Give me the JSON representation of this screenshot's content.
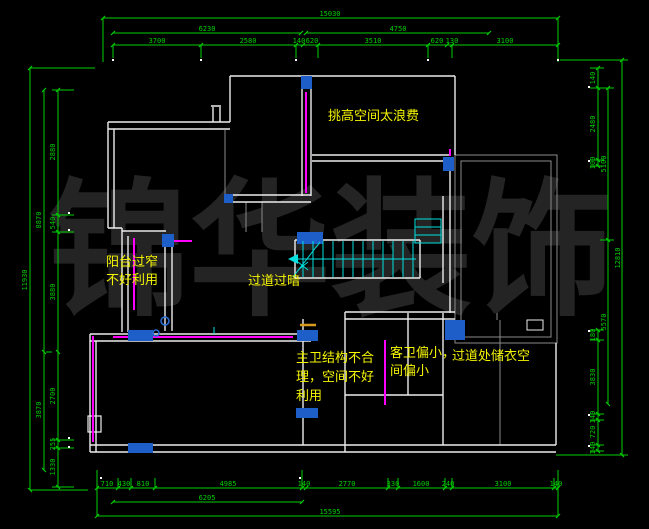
{
  "app": {
    "type": "cad-floor-plan",
    "background": "#000000"
  },
  "watermark": {
    "text": "锦华装饰",
    "color": "#242424"
  },
  "colors": {
    "dimension_green": "#00cf00",
    "wall_white": "#ededed",
    "secondary_gray": "#8a8a8a",
    "accent_magenta": "#ff00ff",
    "fill_blue": "#1d5ec9",
    "stairs_cyan": "#00e0e0",
    "annotation_yellow": "#f5f500",
    "orange": "#d99a1e"
  },
  "annotations": {
    "high_ceiling": "挑高空间太浪费",
    "balcony_line1": "阳台过窄",
    "balcony_line2": "不好利用",
    "corridor_dark": "过道过暗",
    "master_bath_line1": "主卫结构不合",
    "master_bath_line2": "理，空间不好",
    "master_bath_line3": "利用",
    "guest_bath_line1": "客卫偏小，",
    "guest_bath_line2": "间偏小",
    "closet_note": "过道处储衣空"
  },
  "dimensions": {
    "top": {
      "total": "15030",
      "row2": [
        "6230",
        "4750"
      ],
      "row3": [
        "3700",
        "2580",
        "140",
        "620",
        "3510",
        "620",
        "130",
        "3100"
      ]
    },
    "bottom": {
      "row1": [
        "710",
        "430",
        "810",
        "4985",
        "140",
        "2770",
        "330",
        "1600",
        "240",
        "3100",
        "140"
      ],
      "row2": [
        "6205"
      ],
      "total": "15595"
    },
    "left": {
      "outer": "11930",
      "mid": [
        "8870",
        "3870"
      ],
      "inner": [
        "2880",
        "540",
        "3880",
        "2700",
        "255",
        "1330"
      ]
    },
    "right": {
      "outer": "12810",
      "mid": [
        "5100",
        "5570"
      ],
      "inner": [
        "140",
        "2480",
        "100",
        "180",
        "3830",
        "140",
        "720",
        "140"
      ]
    }
  }
}
